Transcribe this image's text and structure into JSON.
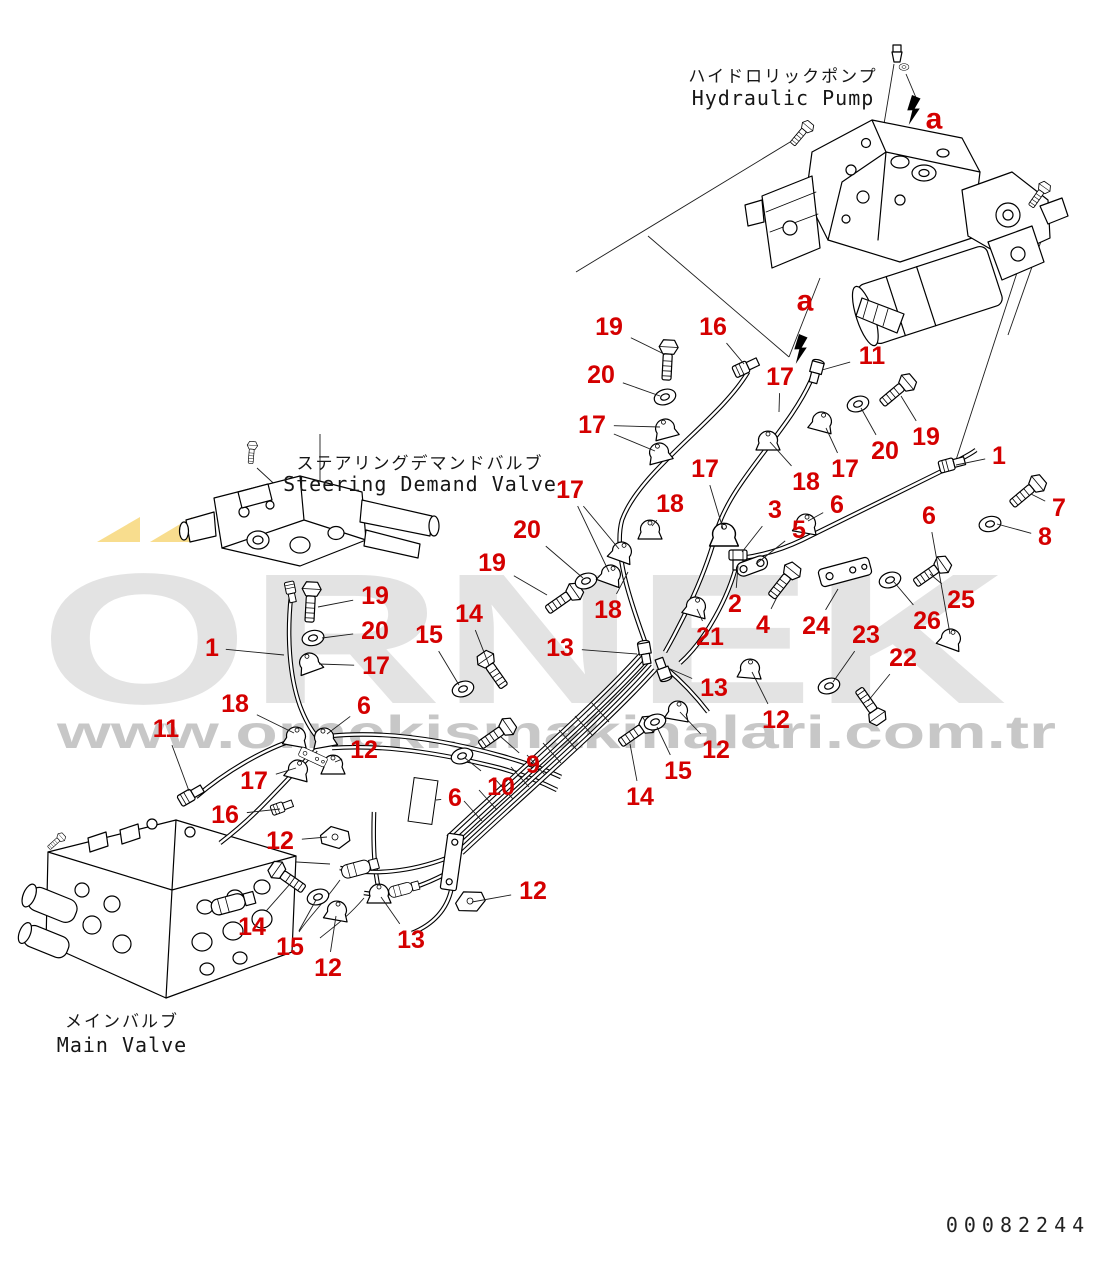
{
  "page_title": "Hydraulic piping parts diagram",
  "labels": {
    "hydraulic_pump": {
      "jp": "ハイドロリックポンプ",
      "en": "Hydraulic Pump",
      "x": 783,
      "jp_y": 82,
      "en_y": 105
    },
    "steering_valve": {
      "jp": "ステアリングデマンドバルブ",
      "en": "Steering Demand Valve",
      "x": 420,
      "jp_y": 469,
      "en_y": 491
    },
    "main_valve": {
      "jp": "メインバルブ",
      "en": "Main Valve",
      "x": 122,
      "jp_y": 1027,
      "en_y": 1052
    }
  },
  "part_number": "00082244",
  "watermark": {
    "brand": "ÖRNEK",
    "brand_plain": "ORNEK",
    "url": "www.ornekismakinalari.com.tr",
    "brand_color": "#e3e3e3",
    "url_color": "#c7c7c7",
    "accent_color": "#f8dd8e"
  },
  "callout_color": "#d40000",
  "leader_color": "#1c1c1c",
  "a_markers": [
    {
      "label": "a",
      "x": 934,
      "y": 119
    },
    {
      "label": "a",
      "x": 805,
      "y": 301
    }
  ],
  "callouts": [
    {
      "n": "19",
      "x": 609,
      "y": 327,
      "t": [
        664,
        354
      ]
    },
    {
      "n": "16",
      "x": 713,
      "y": 327,
      "t": [
        744,
        364
      ]
    },
    {
      "n": "20",
      "x": 601,
      "y": 375,
      "t": [
        660,
        396
      ]
    },
    {
      "n": "17",
      "x": 592,
      "y": 425,
      "t": [
        660,
        427
      ],
      "t2": [
        655,
        451
      ]
    },
    {
      "n": "11",
      "x": 872,
      "y": 356,
      "t": [
        822,
        370
      ]
    },
    {
      "n": "17",
      "x": 780,
      "y": 377,
      "t": [
        779,
        412
      ]
    },
    {
      "n": "20",
      "x": 885,
      "y": 451,
      "t": [
        861,
        408
      ]
    },
    {
      "n": "19",
      "x": 926,
      "y": 437,
      "t": [
        901,
        396
      ]
    },
    {
      "n": "17",
      "x": 845,
      "y": 469,
      "t": [
        826,
        428
      ]
    },
    {
      "n": "18",
      "x": 806,
      "y": 482,
      "t": [
        770,
        442
      ]
    },
    {
      "n": "1",
      "x": 999,
      "y": 456,
      "t": [
        956,
        465
      ]
    },
    {
      "n": "7",
      "x": 1059,
      "y": 508,
      "t": [
        1031,
        494
      ]
    },
    {
      "n": "8",
      "x": 1045,
      "y": 537,
      "t": [
        997,
        524
      ]
    },
    {
      "n": "6",
      "x": 929,
      "y": 516,
      "t": [
        950,
        634
      ]
    },
    {
      "n": "6",
      "x": 837,
      "y": 505,
      "t": [
        808,
        521
      ]
    },
    {
      "n": "3",
      "x": 775,
      "y": 510,
      "t": [
        742,
        552
      ]
    },
    {
      "n": "5",
      "x": 799,
      "y": 530,
      "t": [
        756,
        564
      ]
    },
    {
      "n": "17",
      "x": 705,
      "y": 469,
      "t": [
        723,
        529
      ]
    },
    {
      "n": "18",
      "x": 670,
      "y": 504,
      "t": [
        652,
        526
      ]
    },
    {
      "n": "17",
      "x": 570,
      "y": 490,
      "t": [
        619,
        549
      ],
      "t2": [
        609,
        572
      ]
    },
    {
      "n": "20",
      "x": 527,
      "y": 530,
      "t": [
        583,
        578
      ]
    },
    {
      "n": "19",
      "x": 492,
      "y": 563,
      "t": [
        547,
        595
      ]
    },
    {
      "n": "18",
      "x": 608,
      "y": 610,
      "t": [
        628,
        572
      ]
    },
    {
      "n": "2",
      "x": 735,
      "y": 604,
      "t": [
        738,
        566
      ]
    },
    {
      "n": "21",
      "x": 710,
      "y": 637,
      "t": [
        697,
        609
      ]
    },
    {
      "n": "4",
      "x": 763,
      "y": 625,
      "t": [
        777,
        597
      ]
    },
    {
      "n": "24",
      "x": 816,
      "y": 626,
      "t": [
        838,
        589
      ]
    },
    {
      "n": "23",
      "x": 866,
      "y": 635,
      "t": [
        833,
        682
      ]
    },
    {
      "n": "26",
      "x": 927,
      "y": 621,
      "t": [
        894,
        582
      ]
    },
    {
      "n": "25",
      "x": 961,
      "y": 600,
      "t": [
        930,
        574
      ]
    },
    {
      "n": "22",
      "x": 903,
      "y": 658,
      "t": [
        868,
        701
      ]
    },
    {
      "n": "13",
      "x": 560,
      "y": 648,
      "t": [
        637,
        654
      ]
    },
    {
      "n": "13",
      "x": 714,
      "y": 688,
      "t": [
        668,
        668
      ]
    },
    {
      "n": "12",
      "x": 776,
      "y": 720,
      "t": [
        752,
        672
      ]
    },
    {
      "n": "12",
      "x": 716,
      "y": 750,
      "t": [
        680,
        712
      ]
    },
    {
      "n": "15",
      "x": 678,
      "y": 771,
      "t": [
        657,
        727
      ]
    },
    {
      "n": "14",
      "x": 640,
      "y": 797,
      "t": [
        630,
        744
      ]
    },
    {
      "n": "9",
      "x": 533,
      "y": 765,
      "t": [
        501,
        737
      ]
    },
    {
      "n": "10",
      "x": 501,
      "y": 787,
      "t": [
        465,
        758
      ]
    },
    {
      "n": "6",
      "x": 455,
      "y": 798,
      "t": [
        436,
        800
      ]
    },
    {
      "n": "19",
      "x": 375,
      "y": 596,
      "t": [
        318,
        607
      ]
    },
    {
      "n": "20",
      "x": 375,
      "y": 631,
      "t": [
        322,
        638
      ]
    },
    {
      "n": "17",
      "x": 376,
      "y": 666,
      "t": [
        319,
        664
      ]
    },
    {
      "n": "1",
      "x": 212,
      "y": 648,
      "t": [
        284,
        655
      ]
    },
    {
      "n": "14",
      "x": 469,
      "y": 614,
      "t": [
        489,
        665
      ]
    },
    {
      "n": "15",
      "x": 429,
      "y": 635,
      "t": [
        459,
        685
      ]
    },
    {
      "n": "18",
      "x": 235,
      "y": 704,
      "t": [
        294,
        733
      ]
    },
    {
      "n": "6",
      "x": 364,
      "y": 706,
      "t": [
        327,
        734
      ]
    },
    {
      "n": "12",
      "x": 364,
      "y": 750,
      "t": [
        335,
        762
      ]
    },
    {
      "n": "11",
      "x": 166,
      "y": 729,
      "t": [
        189,
        791
      ]
    },
    {
      "n": "17",
      "x": 254,
      "y": 781,
      "t": [
        296,
        768
      ]
    },
    {
      "n": "16",
      "x": 225,
      "y": 815,
      "t": [
        280,
        809
      ]
    },
    {
      "n": "12",
      "x": 280,
      "y": 841,
      "t": [
        327,
        837
      ]
    },
    {
      "n": "14",
      "x": 252,
      "y": 927,
      "t": [
        290,
        884
      ]
    },
    {
      "n": "15",
      "x": 290,
      "y": 947,
      "t": [
        316,
        900
      ]
    },
    {
      "n": "12",
      "x": 328,
      "y": 968,
      "t": [
        336,
        916
      ]
    },
    {
      "n": "13",
      "x": 411,
      "y": 940,
      "t": [
        381,
        897
      ]
    },
    {
      "n": "12",
      "x": 533,
      "y": 891,
      "t": [
        472,
        902
      ]
    }
  ]
}
